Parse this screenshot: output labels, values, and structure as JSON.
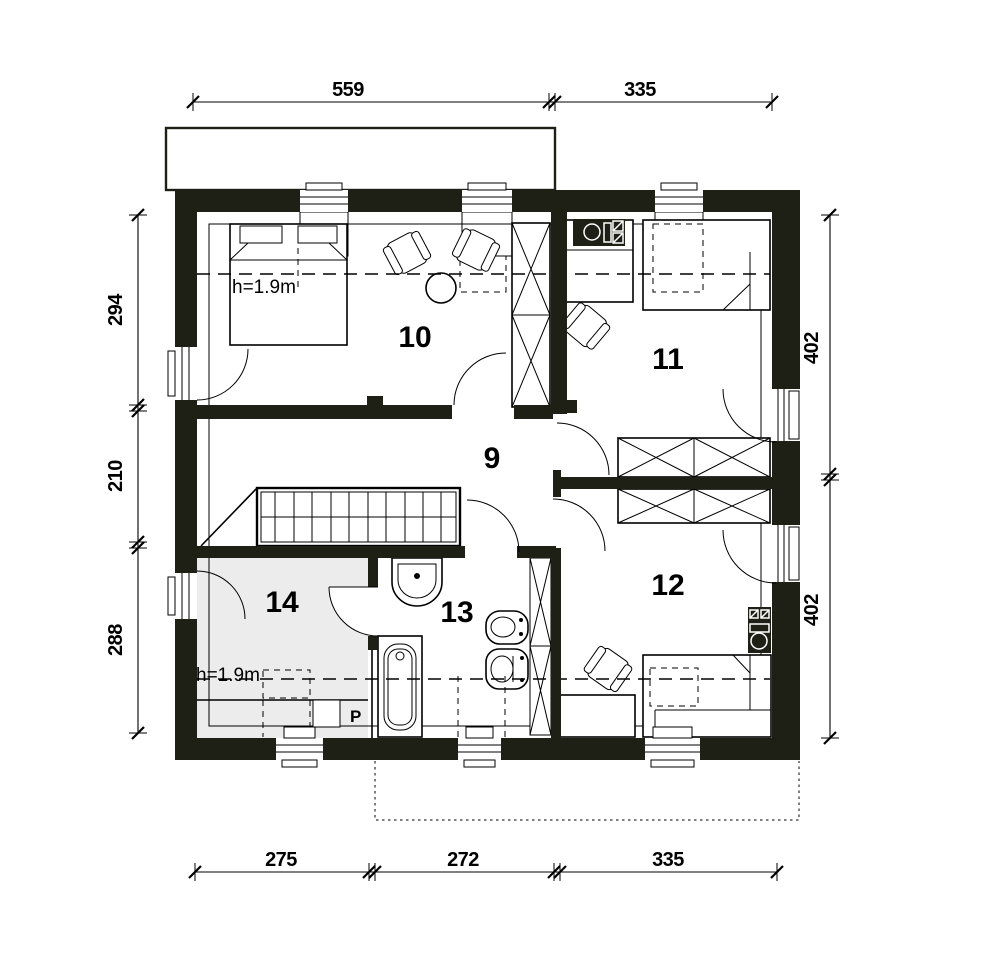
{
  "meta": {
    "title": "Upper storey floor plan"
  },
  "colors": {
    "wall": "#1e1f15",
    "line": "#000000",
    "room14": "#ececec"
  },
  "rooms": {
    "r9": "9",
    "r10": "10",
    "r11": "11",
    "r12": "12",
    "r13": "13",
    "r14": "14"
  },
  "annotations": {
    "ceiling_height_top": "h=1.9m",
    "ceiling_height_bottom": "h=1.9m",
    "washing_machine": "P"
  },
  "dimensions": {
    "top": [
      "559",
      "335"
    ],
    "bottom": [
      "275",
      "272",
      "335"
    ],
    "left": [
      "294",
      "210",
      "288"
    ],
    "right": [
      "402",
      "402"
    ]
  }
}
